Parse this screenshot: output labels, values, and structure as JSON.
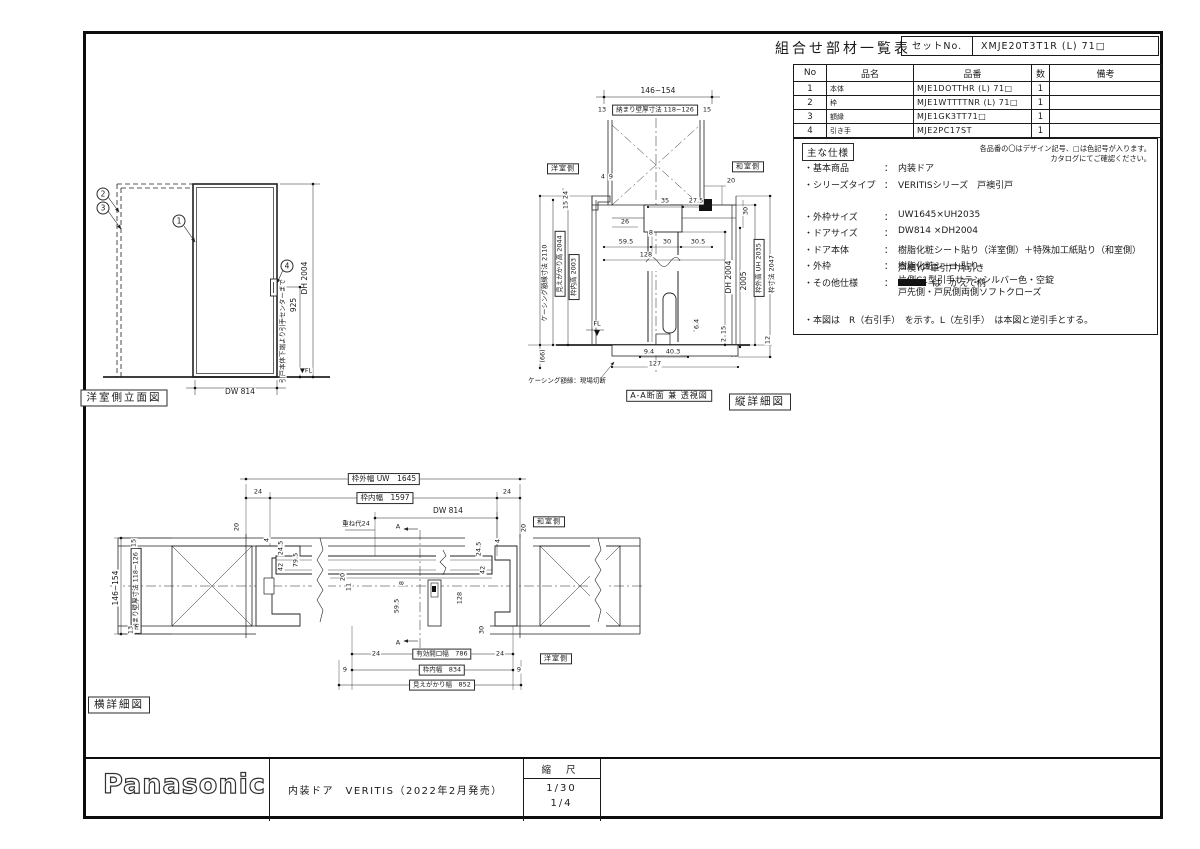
{
  "parts_table": {
    "title": "組合せ部材一覧表",
    "set_no_label": "セットNo.",
    "set_no_value": "XMJE20T3T1R (L) 71□",
    "columns": [
      "No",
      "品名",
      "品番",
      "数",
      "備考"
    ],
    "rows": [
      {
        "no": "1",
        "name": "本体",
        "part_no": "MJE1DOTTHR (L) 71□",
        "qty": "1",
        "remark": ""
      },
      {
        "no": "2",
        "name": "枠",
        "part_no": "MJE1WTTTTNR (L) 71□",
        "qty": "1",
        "remark": ""
      },
      {
        "no": "3",
        "name": "額縁",
        "part_no": "MJE1GK3TT71□",
        "qty": "1",
        "remark": ""
      },
      {
        "no": "4",
        "name": "引き手",
        "part_no": "MJE2PC17ST",
        "qty": "1",
        "remark": ""
      }
    ]
  },
  "spec": {
    "heading": "主な仕様",
    "colon": "：",
    "note_line1": "各品番の〇はデザイン記号、□は色記号が入ります。",
    "note_line2": "カタログにてご確認ください。",
    "items": [
      {
        "label": "・基本商品",
        "value": "内装ドア"
      },
      {
        "label": "・シリーズタイプ",
        "value": "VERITISシリーズ　戸襖引戸"
      },
      {
        "label": "・外枠サイズ",
        "value": "UW1645×UH2035",
        "gap": 1
      },
      {
        "label": "・ドアサイズ",
        "value": "DW814 ×DH2004"
      },
      {
        "label": "・ドア本体",
        "value": "樹脂化粧シート貼り（洋室側）＋特殊加工紙貼り（和室側）"
      },
      {
        "label": "・外枠",
        "value": "樹脂化粧シート貼り"
      },
      {
        "label": "・その他仕様",
        "value": "は　かえで柄",
        "sw": 1
      }
    ],
    "other_lines": [
      "戸襖Y戸車引戸片引き",
      "片側C1型引手サテンシルバー色・空錠",
      "戸先側・戸尻側両側ソフトクローズ"
    ],
    "footnote": "・本図は　R（右引手）　を示す。L（左引手）　は本図と逆引手とする。"
  },
  "views": {
    "elevation": {
      "caption": "洋室側立面図",
      "labels": [
        {
          "t": "2",
          "c": "circ",
          "x": 103,
          "y": 194,
          "n": "balloon-2"
        },
        {
          "t": "3",
          "c": "circ",
          "x": 103,
          "y": 208,
          "n": "balloon-3"
        },
        {
          "t": "1",
          "c": "circ",
          "x": 179,
          "y": 221,
          "n": "balloon-1"
        },
        {
          "t": "4",
          "c": "circ",
          "x": 287,
          "y": 266,
          "n": "balloon-4"
        },
        {
          "t": "DW 814",
          "x": 240,
          "y": 392
        },
        {
          "t": "DH 2004",
          "r": 1,
          "x": 305,
          "y": 278
        },
        {
          "t": "925",
          "r": 1,
          "x": 294,
          "y": 305
        },
        {
          "t": "引戸本体下端より引手センターまで",
          "r": 1,
          "c": "tiny",
          "x": 283,
          "y": 331
        },
        {
          "t": "▼FL",
          "c": "tiny",
          "x": 306,
          "y": 371
        },
        {
          "t": "洋室側立面図",
          "c": "cap",
          "x": 124,
          "y": 398,
          "n": "view-caption"
        }
      ]
    },
    "v_section": {
      "caption": "縦詳細図",
      "labels": [
        {
          "t": "146~154",
          "x": 658,
          "y": 91
        },
        {
          "t": "13",
          "c": "tiny",
          "x": 602,
          "y": 110
        },
        {
          "t": "納まり壁厚寸法 118~126",
          "b": 1,
          "c": "tiny",
          "x": 655,
          "y": 110
        },
        {
          "t": "15",
          "c": "tiny",
          "x": 707,
          "y": 110
        },
        {
          "t": "洋室側",
          "b": 1,
          "c": "room",
          "x": 563,
          "y": 169,
          "n": "room-label"
        },
        {
          "t": "和室側",
          "b": 1,
          "c": "room",
          "x": 748,
          "y": 167,
          "n": "room-label"
        },
        {
          "t": "4",
          "c": "tiny",
          "x": 603,
          "y": 177
        },
        {
          "t": "9",
          "c": "tiny",
          "x": 611,
          "y": 177
        },
        {
          "t": "20",
          "c": "tiny",
          "x": 731,
          "y": 181
        },
        {
          "t": "24",
          "r": 1,
          "c": "tiny",
          "x": 566,
          "y": 195
        },
        {
          "t": "15",
          "r": 1,
          "c": "tiny",
          "x": 566,
          "y": 205
        },
        {
          "t": "35",
          "c": "tiny",
          "x": 665,
          "y": 201
        },
        {
          "t": "27.5",
          "c": "tiny",
          "x": 696,
          "y": 201
        },
        {
          "t": "30",
          "r": 1,
          "c": "tiny",
          "x": 746,
          "y": 211
        },
        {
          "t": "26",
          "c": "tiny",
          "x": 625,
          "y": 222
        },
        {
          "t": "8",
          "c": "tiny",
          "x": 651,
          "y": 233
        },
        {
          "t": "59.5",
          "c": "tiny",
          "x": 626,
          "y": 242
        },
        {
          "t": "30",
          "c": "tiny",
          "x": 667,
          "y": 242
        },
        {
          "t": "30.5",
          "c": "tiny",
          "x": 698,
          "y": 242
        },
        {
          "t": "128",
          "c": "tiny",
          "x": 646,
          "y": 255
        },
        {
          "t": "ケーシング額縁寸法 2110",
          "r": 1,
          "c": "tiny",
          "x": 545,
          "y": 283
        },
        {
          "t": "見えがかり高 2044",
          "r": 1,
          "b": 1,
          "c": "tiny",
          "x": 560,
          "y": 264
        },
        {
          "t": "枠内高 2003",
          "r": 1,
          "b": 1,
          "c": "tiny",
          "x": 574,
          "y": 277
        },
        {
          "t": "DH 2004",
          "r": 1,
          "x": 729,
          "y": 277
        },
        {
          "t": "2005",
          "r": 1,
          "x": 744,
          "y": 281
        },
        {
          "t": "枠外高 UH 2035",
          "r": 1,
          "b": 1,
          "c": "tiny",
          "x": 759,
          "y": 268
        },
        {
          "t": "枠寸法 2047",
          "r": 1,
          "c": "tiny",
          "x": 772,
          "y": 274
        },
        {
          "t": "FL",
          "c": "tiny",
          "x": 597,
          "y": 324
        },
        {
          "t": "6.4",
          "r": 1,
          "c": "tiny",
          "x": 697,
          "y": 324
        },
        {
          "t": "15",
          "r": 1,
          "c": "tiny",
          "x": 724,
          "y": 330
        },
        {
          "t": "2",
          "r": 1,
          "c": "tiny",
          "x": 724,
          "y": 340
        },
        {
          "t": "12",
          "r": 1,
          "c": "tiny",
          "x": 768,
          "y": 340
        },
        {
          "t": "(66)",
          "r": 1,
          "c": "tiny",
          "x": 543,
          "y": 356
        },
        {
          "t": "9.4",
          "c": "tiny",
          "x": 649,
          "y": 352
        },
        {
          "t": "40.3",
          "c": "tiny",
          "x": 673,
          "y": 352
        },
        {
          "t": "127",
          "c": "tiny",
          "x": 655,
          "y": 364
        },
        {
          "t": "ケーシング額縁：現場切断",
          "c": "tiny",
          "x": 567,
          "y": 381
        },
        {
          "t": "A-A断面 兼 透視図",
          "b": 1,
          "c": "seclab",
          "x": 669,
          "y": 396,
          "n": "section-label"
        },
        {
          "t": "縦詳細図",
          "c": "cap",
          "x": 760,
          "y": 402,
          "n": "view-caption"
        }
      ]
    },
    "h_section": {
      "caption": "横詳細図",
      "labels": [
        {
          "t": "146~154",
          "r": 1,
          "x": 116,
          "y": 588
        },
        {
          "t": "納まり壁厚寸法 118~126",
          "r": 1,
          "b": 1,
          "c": "tiny",
          "x": 136,
          "y": 591
        },
        {
          "t": "15",
          "r": 1,
          "c": "tiny",
          "x": 134,
          "y": 543
        },
        {
          "t": "13",
          "r": 1,
          "c": "tiny",
          "x": 131,
          "y": 630
        },
        {
          "t": "枠外幅 UW　1645",
          "b": 1,
          "x": 384,
          "y": 479
        },
        {
          "t": "24",
          "c": "tiny",
          "x": 258,
          "y": 492
        },
        {
          "t": "24",
          "c": "tiny",
          "x": 507,
          "y": 492
        },
        {
          "t": "枠内幅　1597",
          "b": 1,
          "x": 385,
          "y": 498
        },
        {
          "t": "DW 814",
          "x": 448,
          "y": 511
        },
        {
          "t": "重ね代24",
          "c": "tiny",
          "x": 356,
          "y": 524
        },
        {
          "t": "A",
          "c": "tiny",
          "x": 398,
          "y": 527
        },
        {
          "t": "20",
          "r": 1,
          "c": "tiny",
          "x": 237,
          "y": 527
        },
        {
          "t": "20",
          "r": 1,
          "c": "tiny",
          "x": 524,
          "y": 528
        },
        {
          "t": "和室側",
          "b": 1,
          "c": "room",
          "x": 549,
          "y": 522,
          "n": "room-label"
        },
        {
          "t": "4",
          "r": 1,
          "c": "tiny",
          "x": 267,
          "y": 540
        },
        {
          "t": "24.5",
          "r": 1,
          "c": "tiny",
          "x": 281,
          "y": 548
        },
        {
          "t": "42",
          "r": 1,
          "c": "tiny",
          "x": 281,
          "y": 567
        },
        {
          "t": "79.5",
          "r": 1,
          "c": "tiny",
          "x": 296,
          "y": 560
        },
        {
          "t": "4",
          "r": 1,
          "c": "tiny",
          "x": 498,
          "y": 541
        },
        {
          "t": "24.5",
          "r": 1,
          "c": "tiny",
          "x": 479,
          "y": 549
        },
        {
          "t": "42",
          "r": 1,
          "c": "tiny",
          "x": 483,
          "y": 570
        },
        {
          "t": "20",
          "r": 1,
          "c": "tiny",
          "x": 343,
          "y": 577
        },
        {
          "t": "11",
          "r": 1,
          "c": "tiny",
          "x": 349,
          "y": 587
        },
        {
          "t": "8",
          "r": 1,
          "c": "tiny",
          "x": 402,
          "y": 583
        },
        {
          "t": "59.5",
          "r": 1,
          "c": "tiny",
          "x": 397,
          "y": 606
        },
        {
          "t": "128",
          "r": 1,
          "c": "tiny",
          "x": 460,
          "y": 598
        },
        {
          "t": "30",
          "r": 1,
          "c": "tiny",
          "x": 482,
          "y": 630
        },
        {
          "t": "A",
          "c": "tiny",
          "x": 398,
          "y": 643
        },
        {
          "t": "24",
          "c": "tiny",
          "x": 376,
          "y": 654
        },
        {
          "t": "有効開口幅　786",
          "b": 1,
          "c": "tiny",
          "x": 442,
          "y": 654
        },
        {
          "t": "24",
          "c": "tiny",
          "x": 500,
          "y": 654
        },
        {
          "t": "9",
          "c": "tiny",
          "x": 345,
          "y": 670
        },
        {
          "t": "枠内幅　834",
          "b": 1,
          "c": "tiny",
          "x": 442,
          "y": 670
        },
        {
          "t": "9",
          "c": "tiny",
          "x": 519,
          "y": 670
        },
        {
          "t": "見えがかり幅　852",
          "b": 1,
          "c": "tiny",
          "x": 442,
          "y": 685
        },
        {
          "t": "洋室側",
          "b": 1,
          "c": "room",
          "x": 556,
          "y": 659,
          "n": "room-label"
        },
        {
          "t": "横詳細図",
          "c": "cap",
          "x": 119,
          "y": 705,
          "n": "view-caption"
        }
      ]
    }
  },
  "title_block": {
    "brand": "Panasonic",
    "description": "内装ドア　VERITIS（2022年2月発売）",
    "scale_label": "縮 尺",
    "scale_values": [
      "1/30",
      "1/4"
    ]
  }
}
